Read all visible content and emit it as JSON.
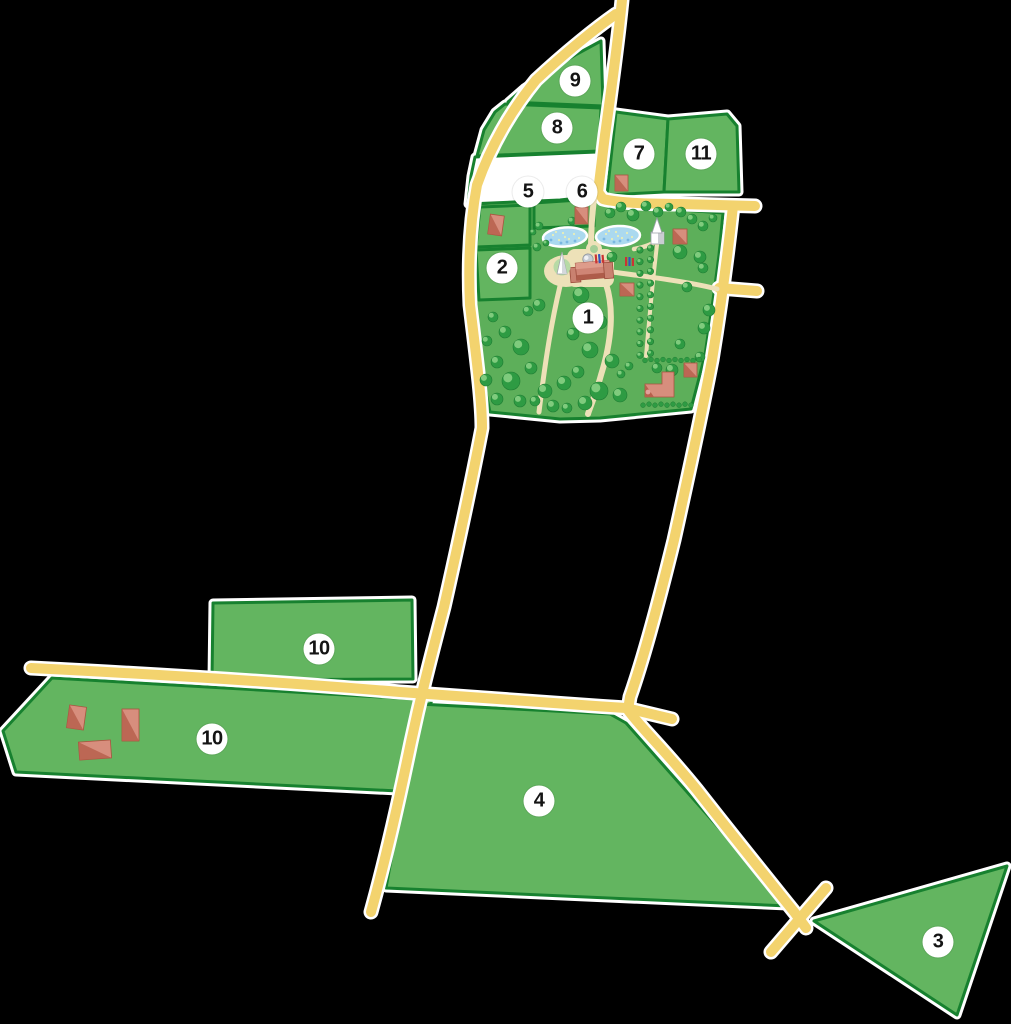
{
  "title": "Illustrated estate plan with numbered plots",
  "map": {
    "width": 1011,
    "height": 1024,
    "background": "#000000",
    "plot_labels": [
      {
        "text": "1",
        "name": "plot-label-1",
        "x": 588,
        "y": 318
      },
      {
        "text": "2",
        "name": "plot-label-2",
        "x": 502,
        "y": 268
      },
      {
        "text": "3",
        "name": "plot-label-3",
        "x": 938,
        "y": 942
      },
      {
        "text": "4",
        "name": "plot-label-4",
        "x": 539,
        "y": 801
      },
      {
        "text": "5",
        "name": "plot-label-5",
        "x": 528,
        "y": 192
      },
      {
        "text": "6",
        "name": "plot-label-6",
        "x": 582,
        "y": 192
      },
      {
        "text": "7",
        "name": "plot-label-7",
        "x": 639,
        "y": 154
      },
      {
        "text": "8",
        "name": "plot-label-8",
        "x": 557,
        "y": 128
      },
      {
        "text": "9",
        "name": "plot-label-9",
        "x": 575,
        "y": 81
      },
      {
        "text": "10",
        "name": "plot-label-10-north",
        "x": 319,
        "y": 649
      },
      {
        "text": "10",
        "name": "plot-label-10-south",
        "x": 212,
        "y": 739
      },
      {
        "text": "11",
        "name": "plot-label-11",
        "x": 701,
        "y": 154
      }
    ],
    "features": [
      "park",
      "ponds",
      "manor-house",
      "church",
      "obelisk",
      "tree-avenue",
      "farm-buildings",
      "roads"
    ],
    "colors": {
      "field": "#63B560",
      "park": "#5DAF5A",
      "plot_border": "#17812F",
      "casing": "#FFFFFF",
      "road": "#F3D36E",
      "path": "#EDE1B8",
      "pond": "#ABD9EF",
      "tree": "#2E9B43",
      "tree_light": "#7FCB7D",
      "building": "#D78E7D",
      "building_dark": "#B7604C",
      "white_plot": "#FFFFFF",
      "label_bg": "#FFFFFF",
      "label_text": "#141414"
    }
  }
}
